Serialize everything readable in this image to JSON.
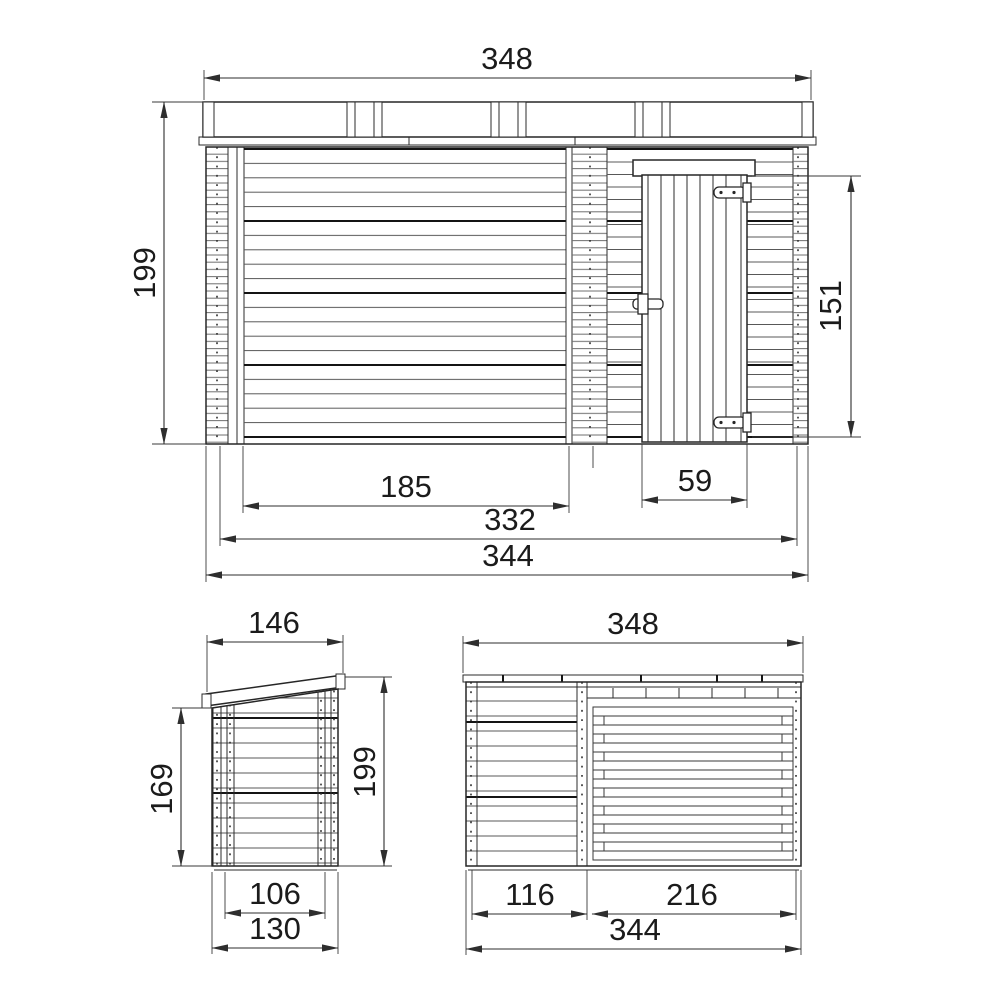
{
  "views": {
    "front": {
      "dims": {
        "roof_width": "348",
        "wall_height": "199",
        "door_height": "151",
        "opening_width": "185",
        "door_width": "59",
        "inner_width": "332",
        "overall_width": "344"
      }
    },
    "side": {
      "dims": {
        "roof_depth": "146",
        "rear_wall_height": "169",
        "front_wall_height": "199",
        "inner_depth": "106",
        "overall_depth": "130"
      }
    },
    "rear": {
      "dims": {
        "roof_width": "348",
        "left_section_width": "116",
        "right_section_width": "216",
        "overall_width": "344"
      }
    }
  },
  "colors": {
    "outline": "#262626",
    "dimension": "#2e2e2e",
    "plank": "#555555",
    "plank_dark": "#141414",
    "background": "#ffffff"
  }
}
